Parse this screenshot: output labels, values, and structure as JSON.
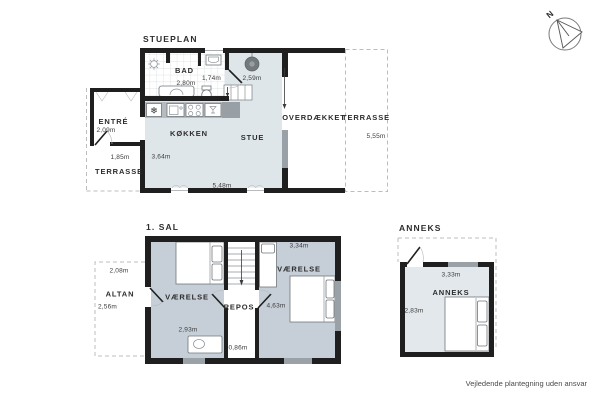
{
  "meta": {
    "compass": "N",
    "disclaimer": "Vejledende plantegning uden ansvar"
  },
  "ground_floor": {
    "title": "STUEPLAN",
    "rooms": {
      "bad": "BAD",
      "entre": "ENTRÉ",
      "terrasse_left": "TERRASSE",
      "kokken": "KØKKEN",
      "stue": "STUE",
      "overdaekket": "OVERDÆKKET",
      "terrasse_right": "TERRASSE"
    },
    "measurements": {
      "bad_width": "2,80m",
      "bad_depth": "1,74m",
      "stove_clearance": "2,59m",
      "entre_width": "2,09m",
      "entre_door": "1,85m",
      "kokken_depth": "3,64m",
      "stue_width": "5,48m",
      "terrasse_depth": "5,55m"
    }
  },
  "first_floor": {
    "title": "1. SAL",
    "rooms": {
      "vaerelse_left": "VÆRELSE",
      "repos": "REPOS",
      "vaerelse_right": "VÆRELSE",
      "altan": "ALTAN"
    },
    "measurements": {
      "altan_width": "2,08m",
      "altan_depth": "2,56m",
      "vaerelse_left_width": "2,93m",
      "repos_width": "0,86m",
      "vaerelse_right_width": "3,34m",
      "vaerelse_right_depth": "4,63m"
    }
  },
  "annex": {
    "title": "ANNEKS",
    "rooms": {
      "anneks": "ANNEKS"
    },
    "measurements": {
      "width": "3,33m",
      "depth": "2,83m"
    }
  },
  "icons": {
    "fridge": "❄"
  },
  "colors": {
    "wall": "#1f1f1f",
    "floor_ground": "#dfe6ea",
    "floor_first": "#c6cfd8",
    "floor_annex": "#e2e8ec",
    "window_fill": "#9aa1a7",
    "counter": "#b5bbc0",
    "dashed_line": "#bcbcbc",
    "text": "#2d2d2d"
  }
}
